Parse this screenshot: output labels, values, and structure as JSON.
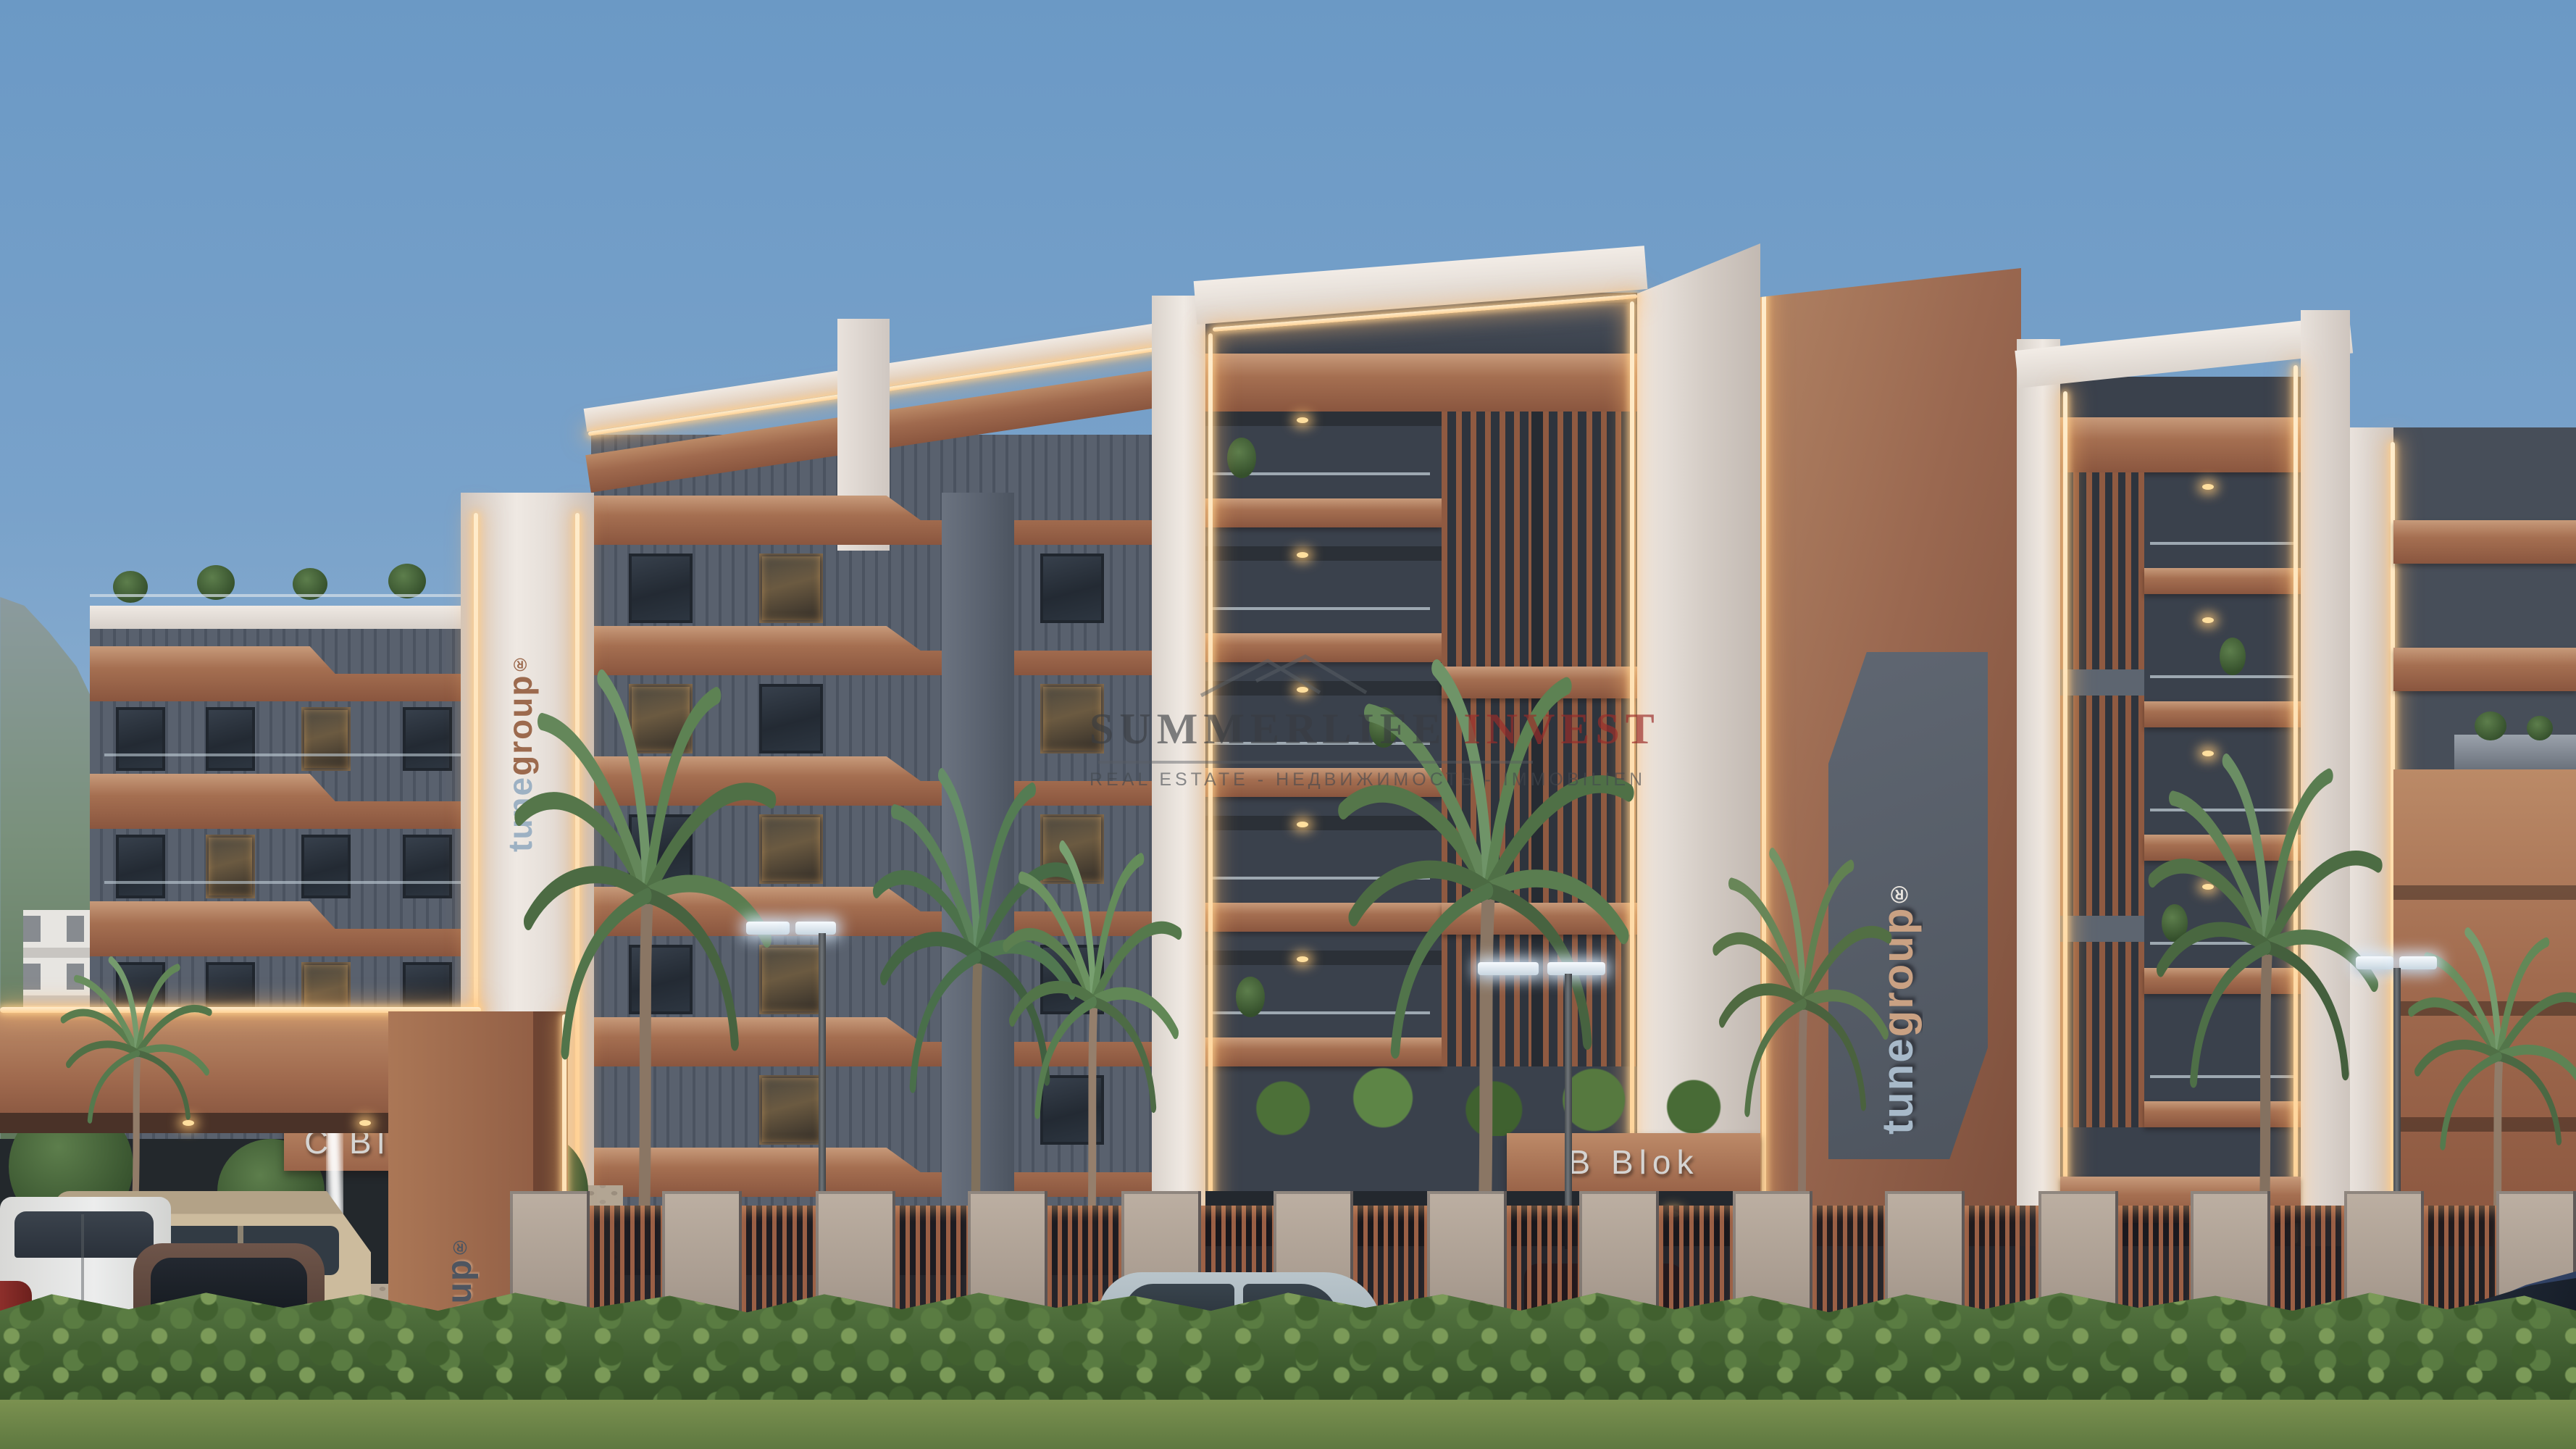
{
  "scene": {
    "type": "architectural-exterior-render",
    "description": "Daylight 3D rendering of a modern residential complex: copper-and-gray apartment blocks with LED-trimmed white frames, rooftop planting, palm trees, entrance portal with fountain, marble fence with copper slats, parked cars, mountains and blue sky behind",
    "branding": {
      "logo_part1": "tune",
      "logo_part2": "group",
      "registered_mark": "®"
    },
    "signs": {
      "left_block": "C Blok",
      "center_block": "B Blok"
    },
    "watermark": {
      "title_primary": "SUMMERLIFE ",
      "title_accent": "INVEST",
      "subtitle": "REAL ESTATE - НЕДВИЖИМОСТЬ - IMMOBILIEN"
    },
    "palette": {
      "sky_top": "#6b99c5",
      "sky_horizon": "#aec5d8",
      "copper": "#9a6750",
      "copper_light": "#c0916f",
      "copper_dark": "#7a4c3a",
      "facade_gray": "#59616e",
      "facade_dark": "#3a414c",
      "white_trim": "#eae4de",
      "led_glow": "#ffd9a4",
      "mountain_left": "#75897c",
      "mountain_right": "#7f99a9",
      "marble_fence": "#ac9f93",
      "hedge_green": "#436134",
      "grass_green": "#6f8748",
      "watermark_gray": "#3f4447",
      "watermark_red": "#a93a38"
    },
    "vehicles": {
      "inside_parking": [
        "white van",
        "beige van",
        "dark red SUV",
        "red car at edge"
      ],
      "street": [
        "light blue sedan",
        "dark blue sedan"
      ]
    }
  }
}
